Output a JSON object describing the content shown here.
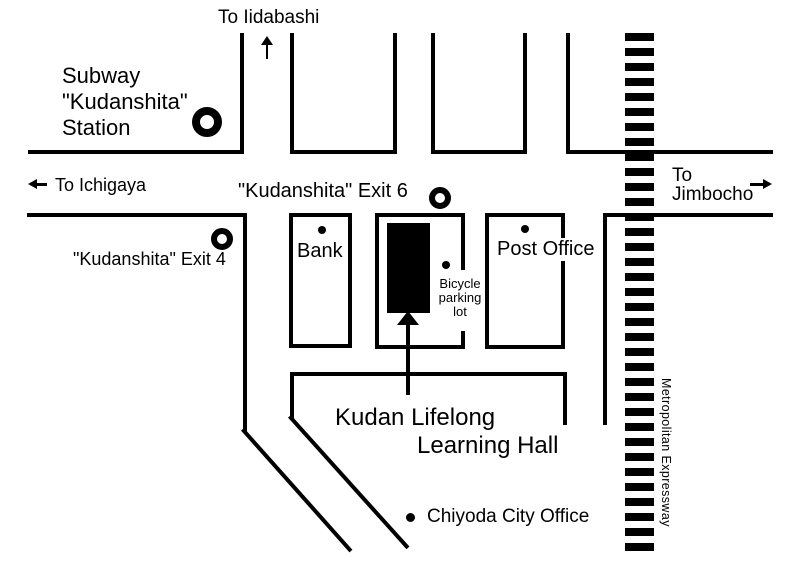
{
  "map": {
    "region_labels": {
      "to_iidabashi": "To Iidabashi",
      "to_ichigaya": "To Ichigaya",
      "to_jimbocho_line1": "To",
      "to_jimbocho_line2": "Jimbocho"
    },
    "station": {
      "name_line1": "Subway",
      "name_line2": "\"Kudanshita\"",
      "name_line3": "Station",
      "exit6_label": "\"Kudanshita\" Exit 6",
      "exit4_label": "\"Kudanshita\" Exit 4"
    },
    "buildings": {
      "bank": "Bank",
      "post_office": "Post Office",
      "bicycle_parking_line1": "Bicycle",
      "bicycle_parking_line2": "parking",
      "bicycle_parking_line3": "lot"
    },
    "destination": {
      "name_line1": "Kudan Lifelong",
      "name_line2": "Learning Hall"
    },
    "landmarks": {
      "chiyoda_city_office": "Chiyoda City Office"
    },
    "expressway_label": "Metropolitan Expressway",
    "colors": {
      "line": "#000000",
      "background": "#ffffff"
    }
  }
}
